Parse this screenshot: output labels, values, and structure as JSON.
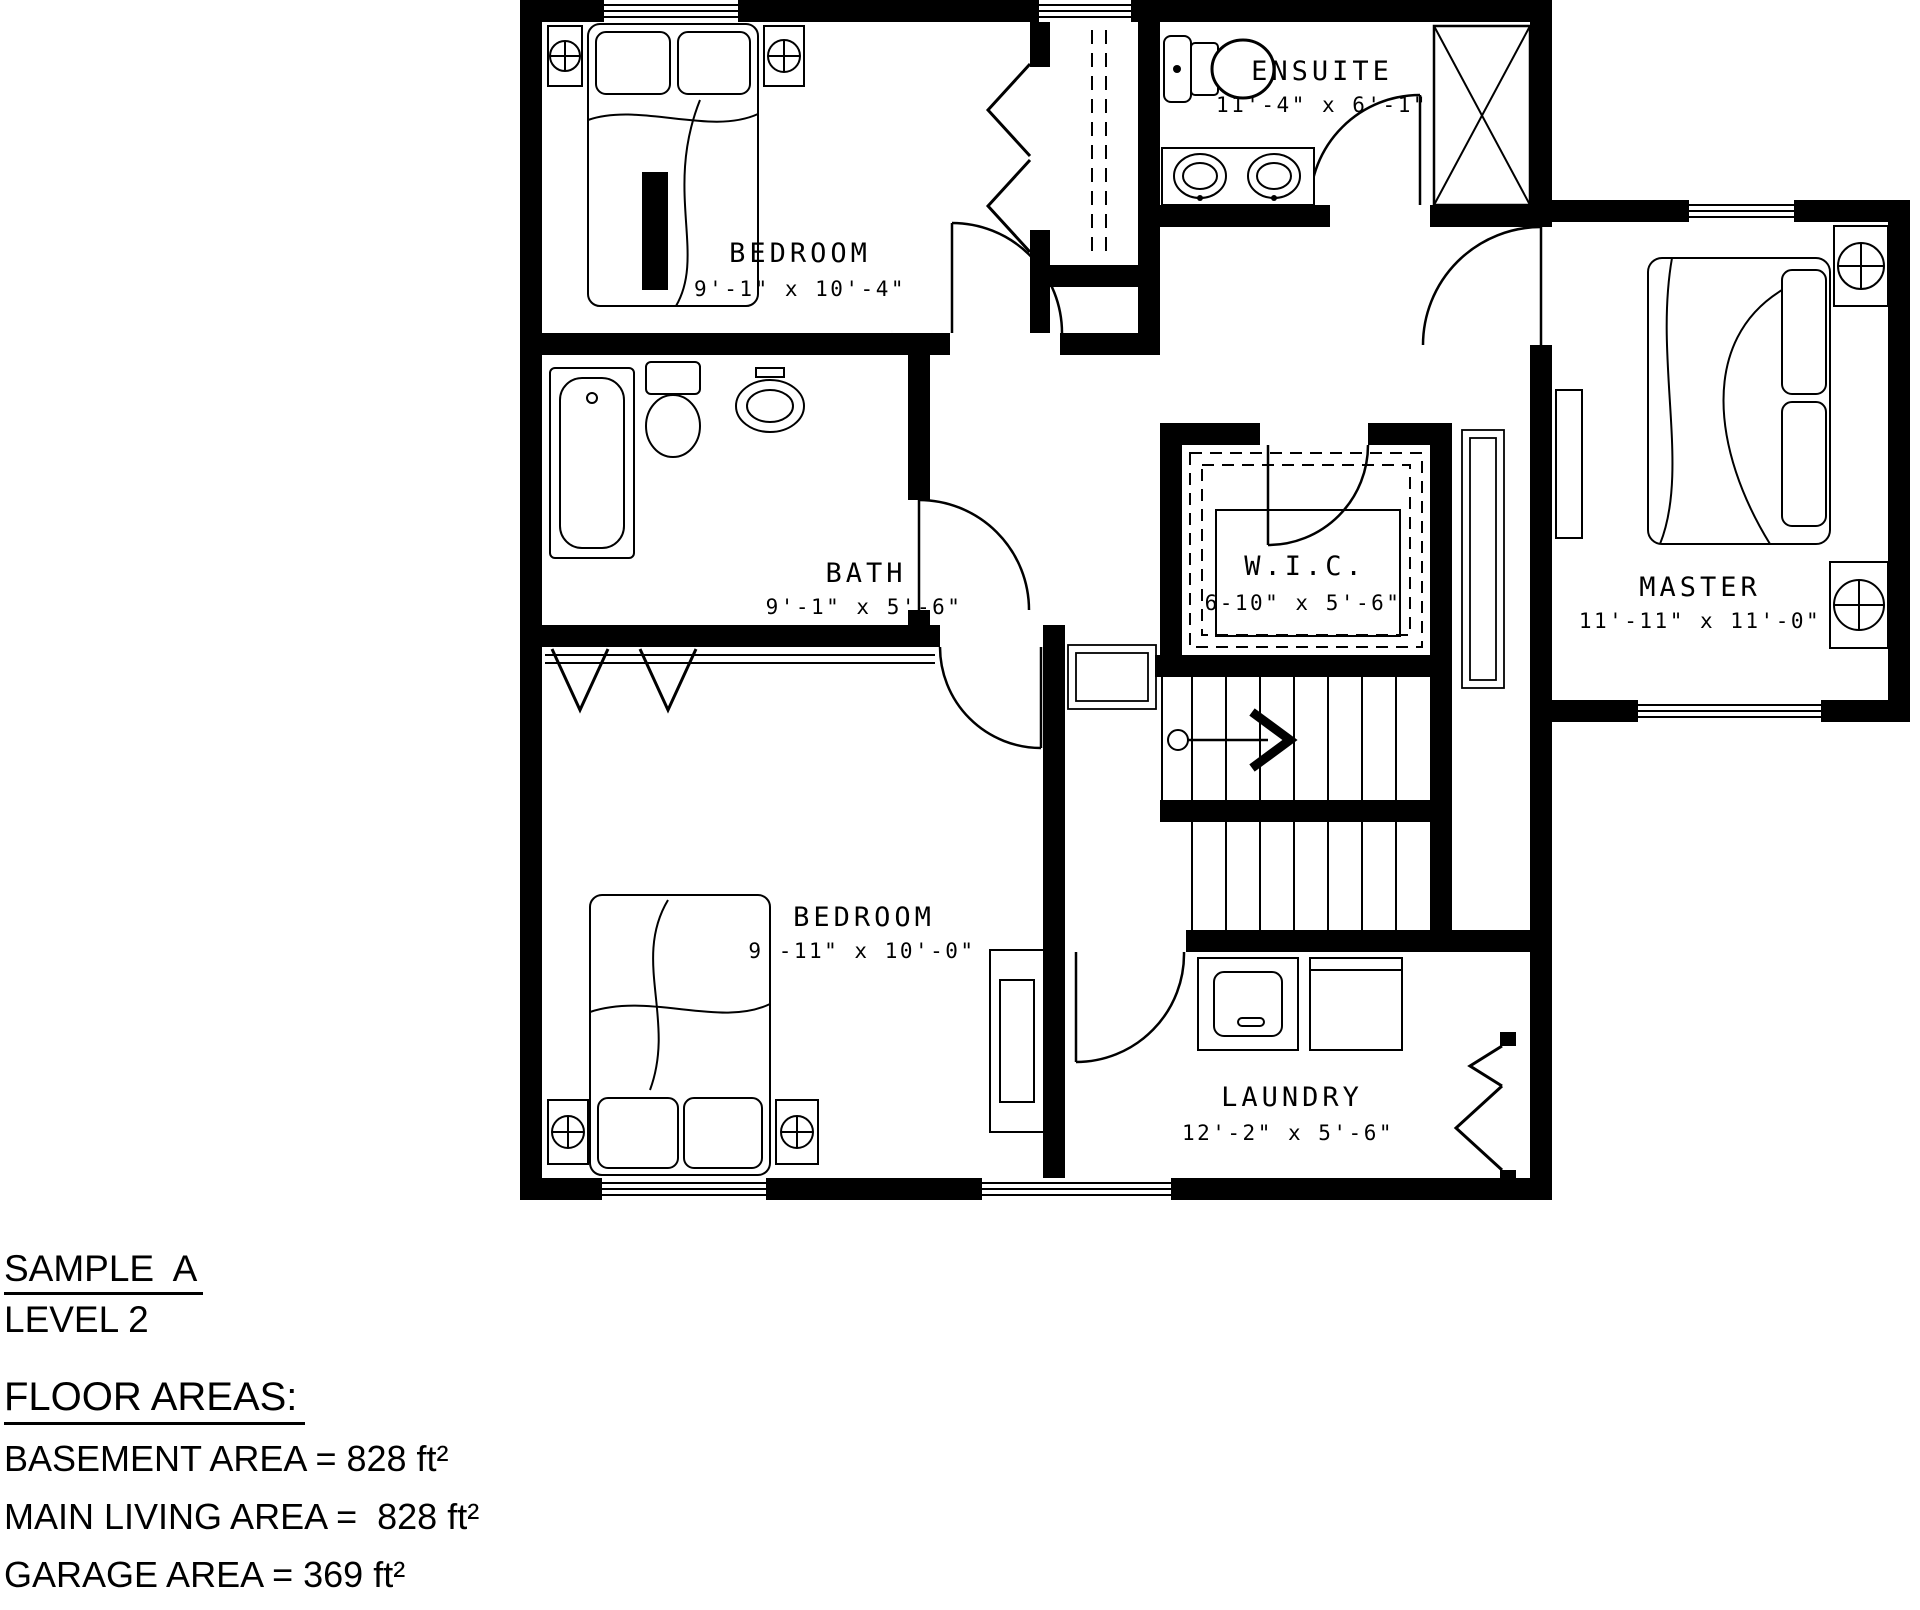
{
  "plan": {
    "rooms": [
      {
        "id": "bedroom-1",
        "name": "BEDROOM",
        "dims": "9'-1\" x 10'-4\""
      },
      {
        "id": "ensuite",
        "name": "ENSUITE",
        "dims": "11'-4\" x 6'-1\""
      },
      {
        "id": "master",
        "name": "MASTER",
        "dims": "11'-11\" x 11'-0\""
      },
      {
        "id": "bath",
        "name": "BATH",
        "dims": "9'-1\" x 5'-6\""
      },
      {
        "id": "wic",
        "name": "W.I.C.",
        "dims": "6-10\" x 5'-6\""
      },
      {
        "id": "bedroom-2",
        "name": "BEDROOM",
        "dims": "9'-11\" x 10'-0\""
      },
      {
        "id": "laundry",
        "name": "LAUNDRY",
        "dims": "12'-2\" x 5'-6\""
      }
    ],
    "colors": {
      "wall": "#000000",
      "line": "#000000",
      "background": "#ffffff"
    }
  },
  "title_block": {
    "project": "SAMPLE  A",
    "level": "LEVEL 2",
    "heading": "FLOOR AREAS:",
    "lines": [
      "BASEMENT AREA = 828 ft²",
      "MAIN LIVING AREA =  828 ft²",
      "GARAGE AREA = 369 ft²",
      "SECOND LEVEL = 832 ft²"
    ]
  }
}
